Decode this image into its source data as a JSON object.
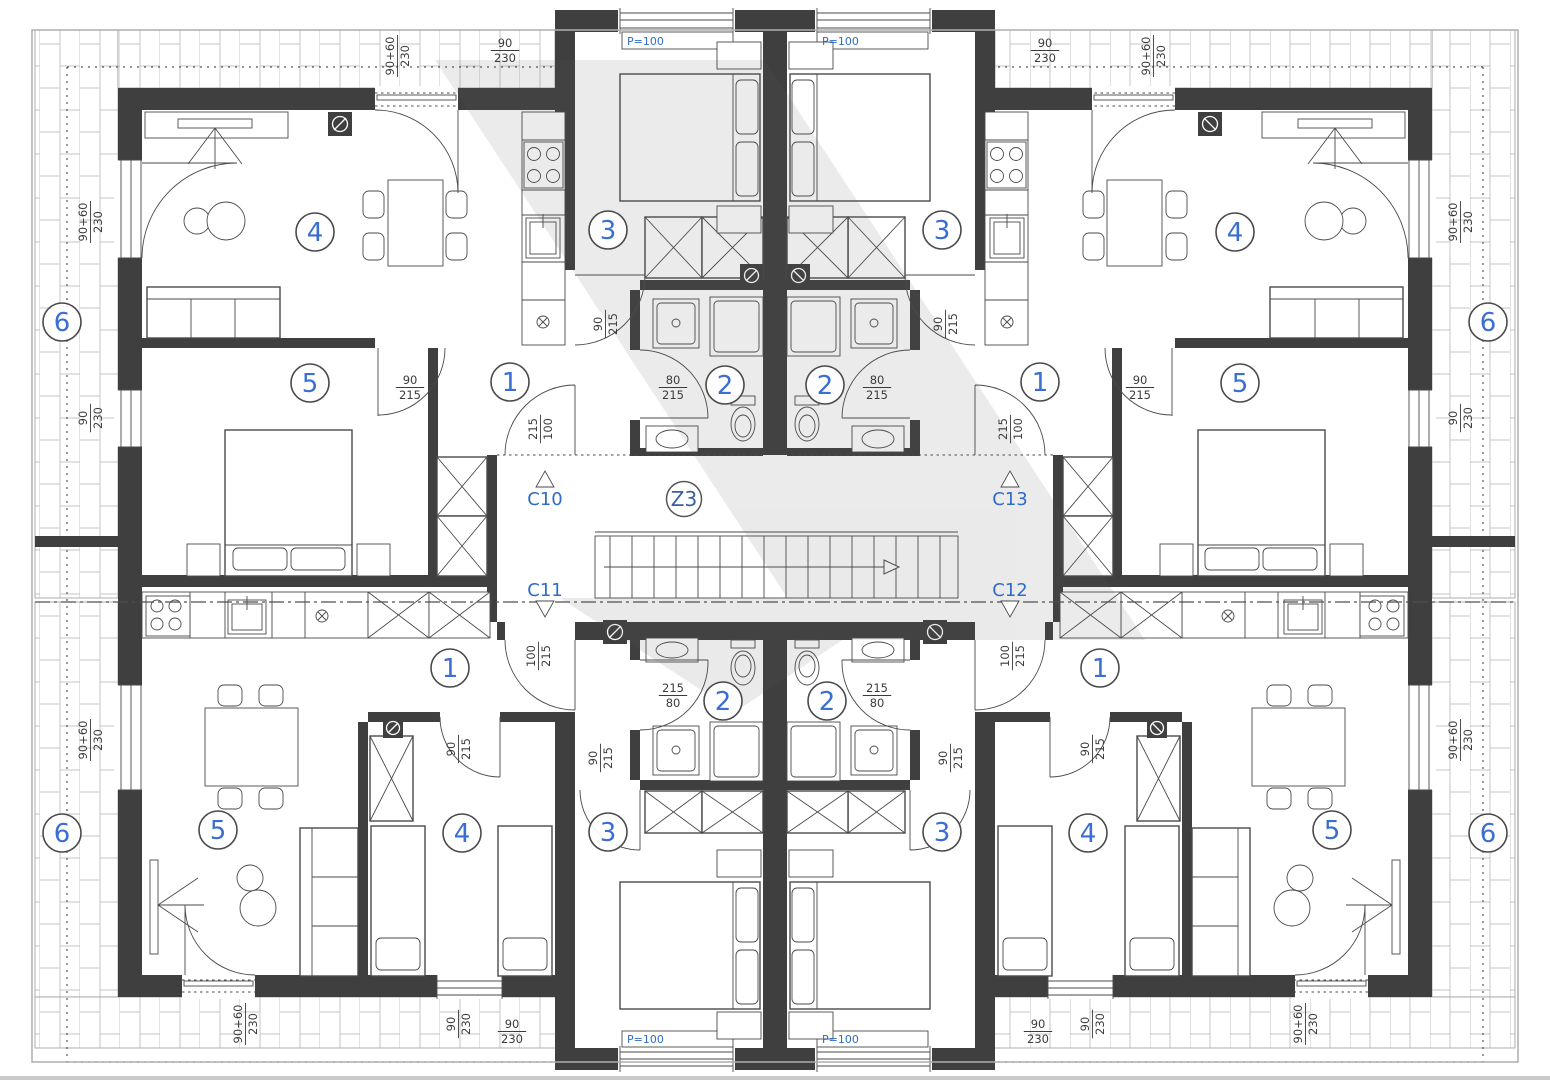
{
  "plan": {
    "stairwell": {
      "label": "Z3"
    },
    "section_markers": [
      {
        "label": "C10"
      },
      {
        "label": "C11"
      },
      {
        "label": "C12"
      },
      {
        "label": "C13"
      }
    ],
    "parapet_labels": [
      "P=100",
      "P=100",
      "P=100",
      "P=100"
    ],
    "room_markers": [
      [
        62,
        322,
        "6"
      ],
      [
        62,
        833,
        "6"
      ],
      [
        1488,
        322,
        "6"
      ],
      [
        1488,
        833,
        "6"
      ],
      [
        315,
        232,
        "4"
      ],
      [
        310,
        383,
        "5"
      ],
      [
        510,
        382,
        "1"
      ],
      [
        608,
        230,
        "3"
      ],
      [
        725,
        385,
        "2"
      ],
      [
        1235,
        232,
        "4"
      ],
      [
        1240,
        383,
        "5"
      ],
      [
        1040,
        382,
        "1"
      ],
      [
        942,
        230,
        "3"
      ],
      [
        825,
        385,
        "2"
      ],
      [
        450,
        668,
        "1"
      ],
      [
        218,
        830,
        "5"
      ],
      [
        462,
        833,
        "4"
      ],
      [
        608,
        832,
        "3"
      ],
      [
        723,
        701,
        "2"
      ],
      [
        1100,
        668,
        "1"
      ],
      [
        1332,
        830,
        "5"
      ],
      [
        1088,
        833,
        "4"
      ],
      [
        942,
        832,
        "3"
      ],
      [
        827,
        701,
        "2"
      ]
    ],
    "dimension_labels": [
      [
        90,
        222,
        -90,
        "90+60",
        "230"
      ],
      [
        90,
        418,
        -90,
        "90",
        "230"
      ],
      [
        90,
        740,
        -90,
        "90+60",
        "230"
      ],
      [
        1460,
        222,
        -90,
        "90+60",
        "230"
      ],
      [
        1460,
        418,
        -90,
        "90",
        "230"
      ],
      [
        1460,
        740,
        -90,
        "90+60",
        "230"
      ],
      [
        397,
        56,
        -90,
        "90+60",
        "230"
      ],
      [
        1153,
        56,
        -90,
        "90+60",
        "230"
      ],
      [
        505,
        50,
        0,
        "90",
        "230"
      ],
      [
        1045,
        50,
        0,
        "90",
        "230"
      ],
      [
        245,
        1024,
        -90,
        "90+60",
        "230"
      ],
      [
        1305,
        1024,
        -90,
        "90+60",
        "230"
      ],
      [
        458,
        1024,
        -90,
        "90",
        "230"
      ],
      [
        1092,
        1024,
        -90,
        "90",
        "230"
      ],
      [
        512,
        1031,
        0,
        "90",
        "230"
      ],
      [
        1038,
        1031,
        0,
        "90",
        "230"
      ],
      [
        410,
        387,
        0,
        "90",
        "215"
      ],
      [
        1140,
        387,
        0,
        "90",
        "215"
      ],
      [
        605,
        324,
        -90,
        "90",
        "215"
      ],
      [
        945,
        324,
        -90,
        "90",
        "215"
      ],
      [
        673,
        387,
        0,
        "80",
        "215"
      ],
      [
        877,
        387,
        0,
        "80",
        "215"
      ],
      [
        540,
        429,
        -90,
        "215",
        "100"
      ],
      [
        1010,
        429,
        -90,
        "215",
        "100"
      ],
      [
        538,
        656,
        -90,
        "100",
        "215"
      ],
      [
        1012,
        656,
        -90,
        "100",
        "215"
      ],
      [
        673,
        695,
        0,
        "215",
        "80"
      ],
      [
        877,
        695,
        0,
        "215",
        "80"
      ],
      [
        458,
        749,
        -90,
        "90",
        "215"
      ],
      [
        1092,
        749,
        -90,
        "90",
        "215"
      ],
      [
        600,
        758,
        -90,
        "90",
        "215"
      ],
      [
        950,
        758,
        -90,
        "90",
        "215"
      ]
    ],
    "colors": {
      "wall": "#3f3f3f",
      "line": "#4a4a4a",
      "blue": "#2f6cc8",
      "number_blue": "#3a6ed0",
      "dim_text": "#3b3b3b",
      "hatch": "#c6c6c6",
      "watermark": "#5a5a5a"
    }
  }
}
